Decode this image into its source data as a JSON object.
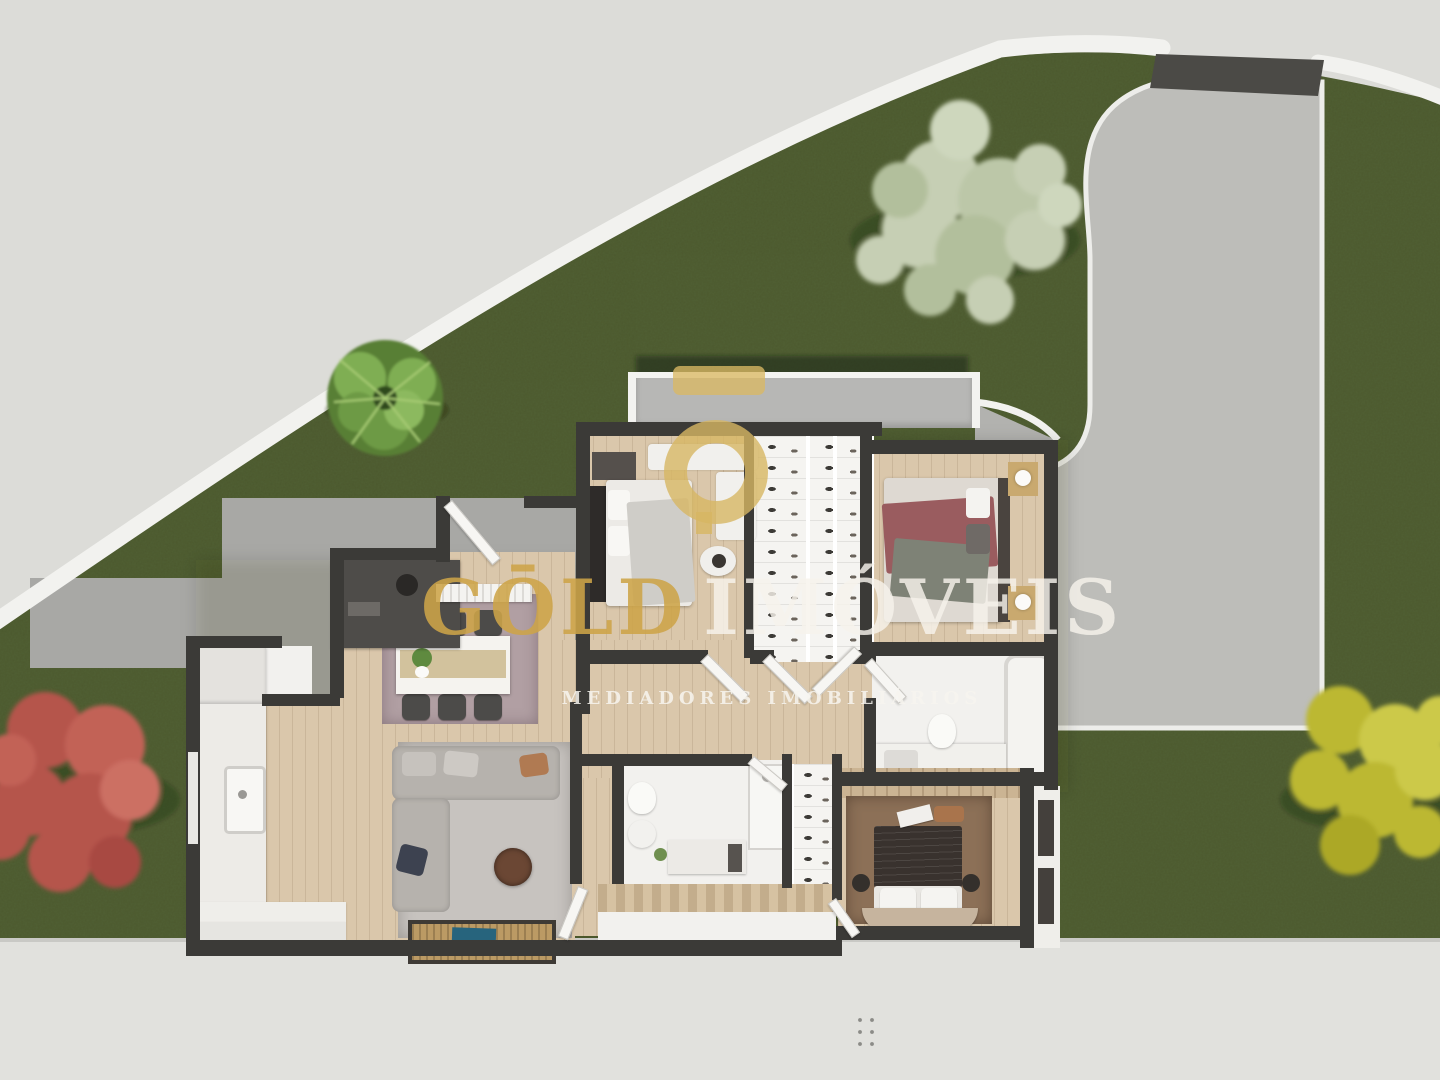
{
  "brand": {
    "logo_mark_icon": "gold-imoveis-o-macron-ring",
    "wordmark_gold": "GŌLD",
    "wordmark_light": "IMÓVEIS",
    "tagline": "MEDIADORES IMOBILIÁRIOS"
  },
  "palette": {
    "brand_gold": "#D3AE5E",
    "lawn": "#4C592E",
    "street": "#DCDCD8",
    "sidewalk": "#E1E1DD",
    "driveway": "#BDBDB9",
    "patio": "#A8A8A5",
    "fence": "#F2F2EF",
    "wall": "#3B3A37",
    "wood_floor": "#DAC7AB",
    "white_floor": "#F2F1EE",
    "dining_rug": "#B19FA3",
    "living_rug": "#C7C3BF",
    "bedroom_rug": "#8C7057"
  },
  "scene": {
    "type": "3d-top-view-floor-plan",
    "rooms": [
      {
        "name": "balcony"
      },
      {
        "name": "bedroom-top-left"
      },
      {
        "name": "wardrobe-closet-left"
      },
      {
        "name": "wardrobe-closet-right"
      },
      {
        "name": "bedroom-top-right"
      },
      {
        "name": "bathroom-main"
      },
      {
        "name": "hallway"
      },
      {
        "name": "dining-room"
      },
      {
        "name": "kitchen"
      },
      {
        "name": "living-room"
      },
      {
        "name": "bathroom-small"
      },
      {
        "name": "shoe-closet"
      },
      {
        "name": "bedroom-bottom-right"
      },
      {
        "name": "stair-hall"
      }
    ],
    "exterior": [
      "lawn",
      "curved-white-fence",
      "entrance-gate",
      "driveway",
      "patio",
      "sidewalk",
      "palm-plant",
      "white-flowering-tree",
      "red-tree",
      "yellow-tree"
    ]
  }
}
